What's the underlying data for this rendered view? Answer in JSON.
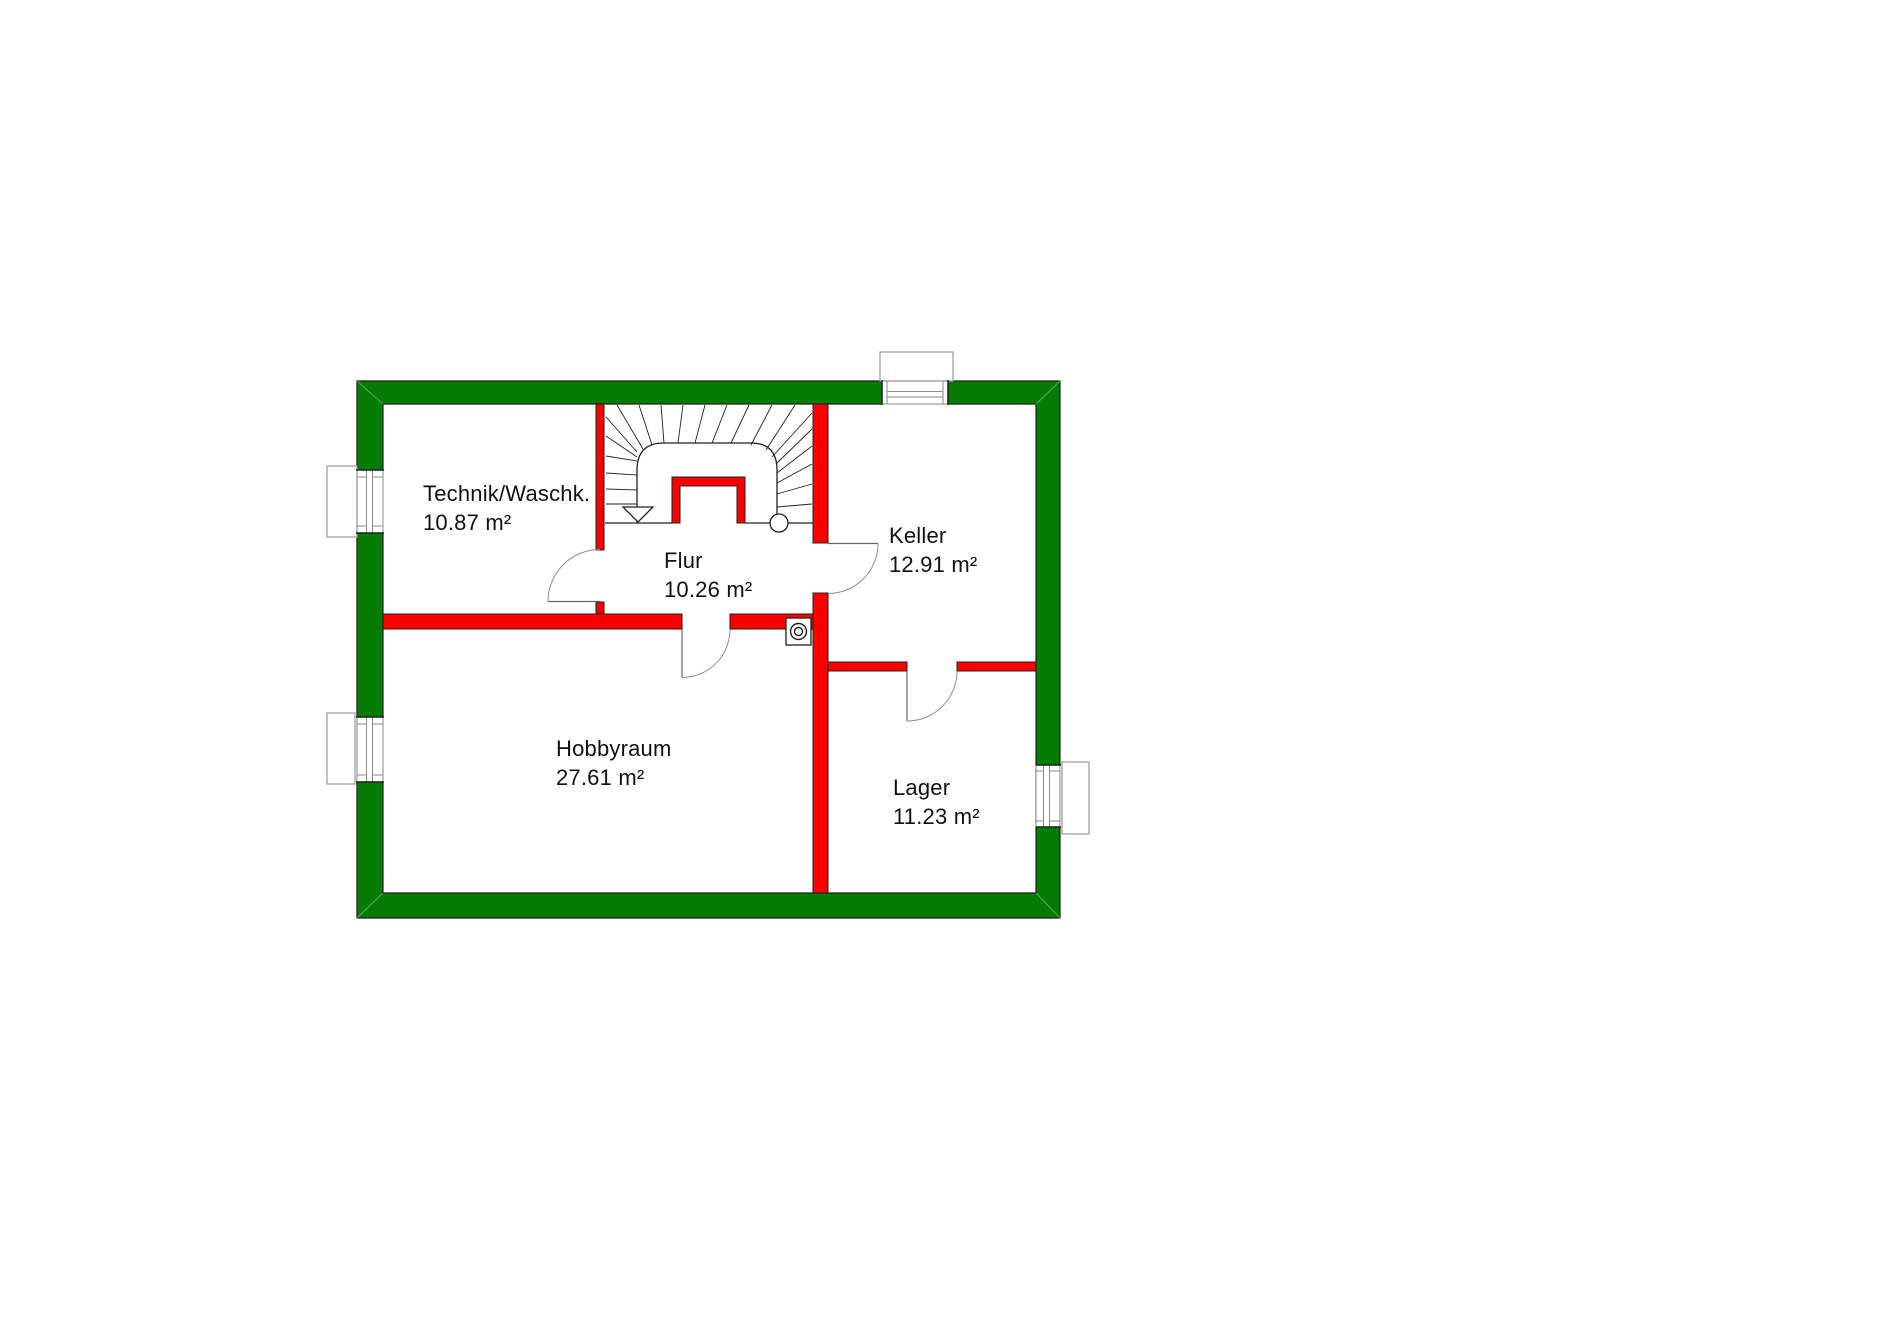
{
  "plan": {
    "rooms": [
      {
        "name": "Technik/Waschk.",
        "area": "10.87 m²"
      },
      {
        "name": "Flur",
        "area": "10.26 m²"
      },
      {
        "name": "Keller",
        "area": "12.91 m²"
      },
      {
        "name": "Hobbyraum",
        "area": "27.61 m²"
      },
      {
        "name": "Lager",
        "area": "11.23 m²"
      }
    ],
    "colors": {
      "exterior_wall": "#047c04",
      "interior_wall": "#fb0000",
      "outline": "#1f1f1f"
    },
    "symbols": {
      "stair_direction_icon": "▽",
      "drain_icon": "◎"
    }
  }
}
